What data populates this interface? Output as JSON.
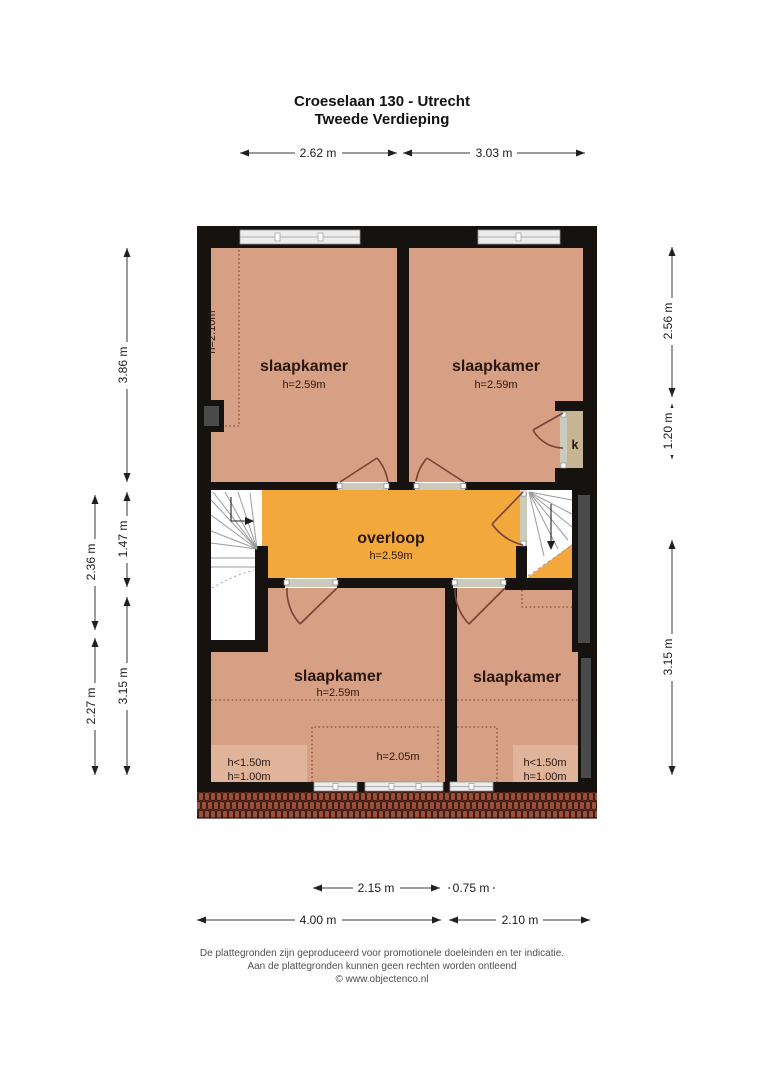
{
  "title": {
    "line1": "Croeselaan 130 - Utrecht",
    "line2": "Tweede Verdieping"
  },
  "rooms": {
    "bedroom_top_left": {
      "label": "slaapkamer",
      "ceiling": "h=2.59m"
    },
    "bedroom_top_right": {
      "label": "slaapkamer",
      "ceiling": "h=2.59m"
    },
    "bedroom_bottom_left": {
      "label": "slaapkamer",
      "ceiling": "h=2.59m"
    },
    "bedroom_bottom_right": {
      "label": "slaapkamer"
    },
    "landing": {
      "label": "overloop",
      "ceiling": "h=2.59m"
    },
    "closet": {
      "label": "k"
    }
  },
  "annotations": {
    "sloped_ceiling_top_left": "h=2.10m",
    "dormer_height": "h=2.05m",
    "low_ceiling_left": {
      "line1": "h<1.50m",
      "line2": "h=1.00m"
    },
    "low_ceiling_right": {
      "line1": "h<1.50m",
      "line2": "h=1.00m"
    }
  },
  "dimensions": {
    "top": [
      "2.62 m",
      "3.03 m"
    ],
    "left_outer": [
      "2.36 m",
      "2.27 m"
    ],
    "left_inner": [
      "3.86 m",
      "1.47 m",
      "3.15 m"
    ],
    "right": [
      "2.56 m",
      "1.20 m",
      "3.15 m"
    ],
    "bottom_row1": [
      "2.15 m",
      "0.75 m"
    ],
    "bottom_row2": [
      "4.00 m",
      "2.10 m"
    ]
  },
  "footer": {
    "line1": "De plattegronden zijn geproduceerd voor promotionele doeleinden en ter indicatie.",
    "line2": "Aan de plattegronden kunnen geen rechten worden ontleend",
    "line3": "© www.objectenco.nl"
  },
  "colors": {
    "room_fill": "#d7a084",
    "room_low_fill": "#e0b49b",
    "landing_fill": "#f3a83b",
    "closet_fill": "#c6b494",
    "wall": "#151210",
    "niche": "#4a4a4a",
    "roof_tile": "#9c4e3a",
    "door": "#7a4136"
  }
}
